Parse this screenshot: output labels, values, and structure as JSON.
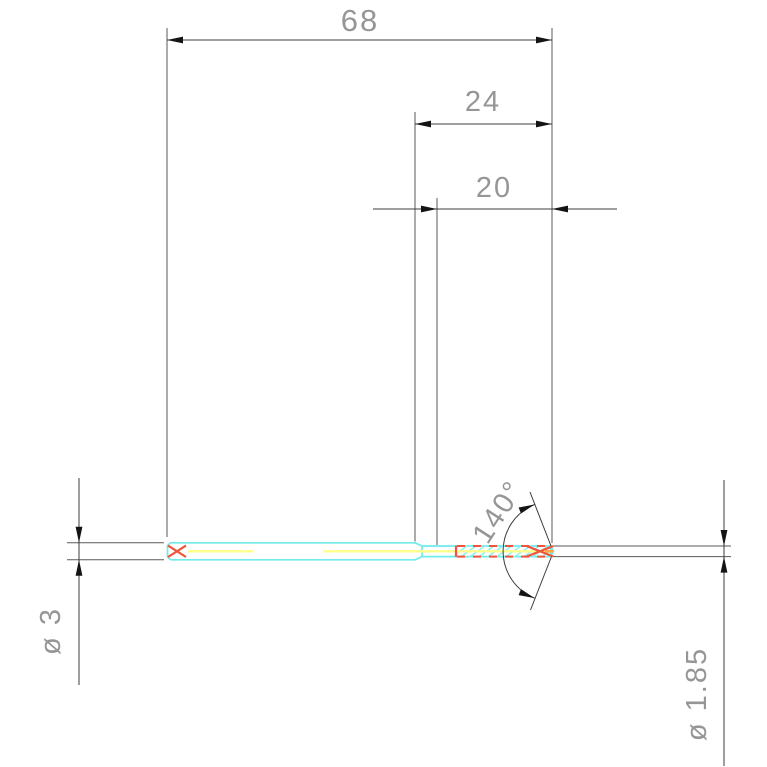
{
  "drawing": {
    "type": "cad-technical-drawing",
    "subject": "drill bit side view with dimensions",
    "units": "mm",
    "colors": {
      "background": "#ffffff",
      "tool_outline": "#6eebeb",
      "flute_hatch": "#8df0f0",
      "centerline": "#ffff8c",
      "center_marks": "#f0553c",
      "dimension_lines": "#3c3c3c",
      "arrowheads": "#141414",
      "dimension_text": "#969696"
    },
    "dimensions": {
      "overall_length": {
        "label": "68",
        "value": 68
      },
      "step_length": {
        "label": "24",
        "value": 24
      },
      "flute_length": {
        "label": "20",
        "value": 20
      },
      "point_angle": {
        "label": "140°",
        "value": 140
      },
      "shank_diameter": {
        "label": "ø 3",
        "value": 3
      },
      "cutting_diameter": {
        "label": "ø 1.85",
        "value": 1.85
      }
    }
  }
}
